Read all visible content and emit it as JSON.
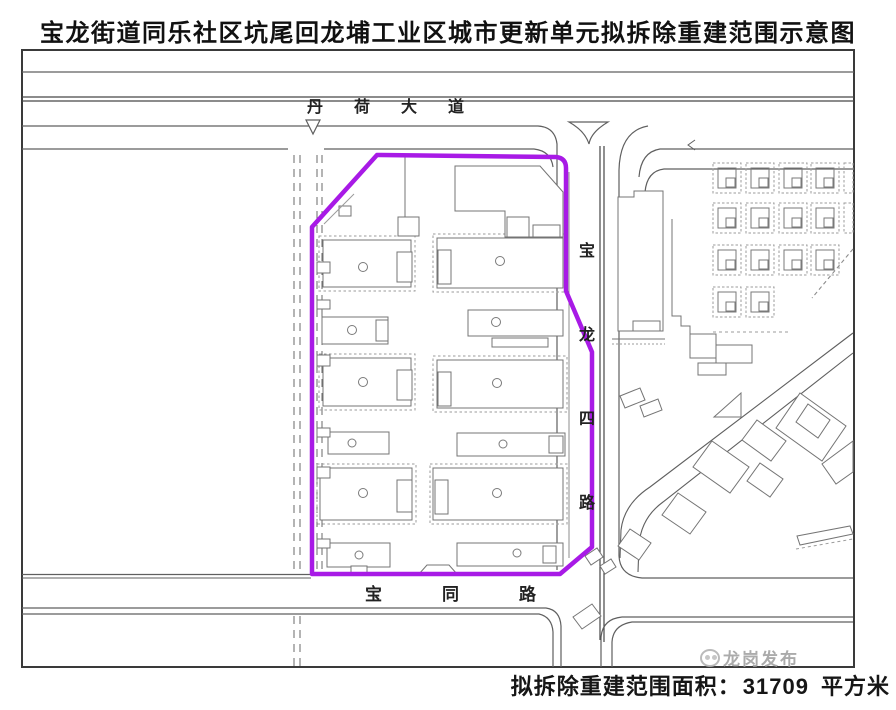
{
  "title": "宝龙街道同乐社区坑尾回龙埔工业区城市更新单元拟拆除重建范围示意图",
  "map": {
    "roads": {
      "danhe": {
        "label": "丹荷大道",
        "chars": [
          "丹",
          "荷",
          "大",
          "道"
        ]
      },
      "baolong": {
        "label": "宝龙四路",
        "chars": [
          "宝",
          "龙",
          "四",
          "路"
        ]
      },
      "baotong": {
        "label": "宝同路",
        "chars": [
          "宝",
          "同",
          "路"
        ]
      }
    },
    "boundary": {
      "color": "#A81AE6"
    }
  },
  "footer": {
    "area_label": "拟拆除重建范围面积：",
    "area_value": "31709",
    "area_unit": "平方米"
  },
  "watermark": {
    "text": "龙岗发布"
  }
}
